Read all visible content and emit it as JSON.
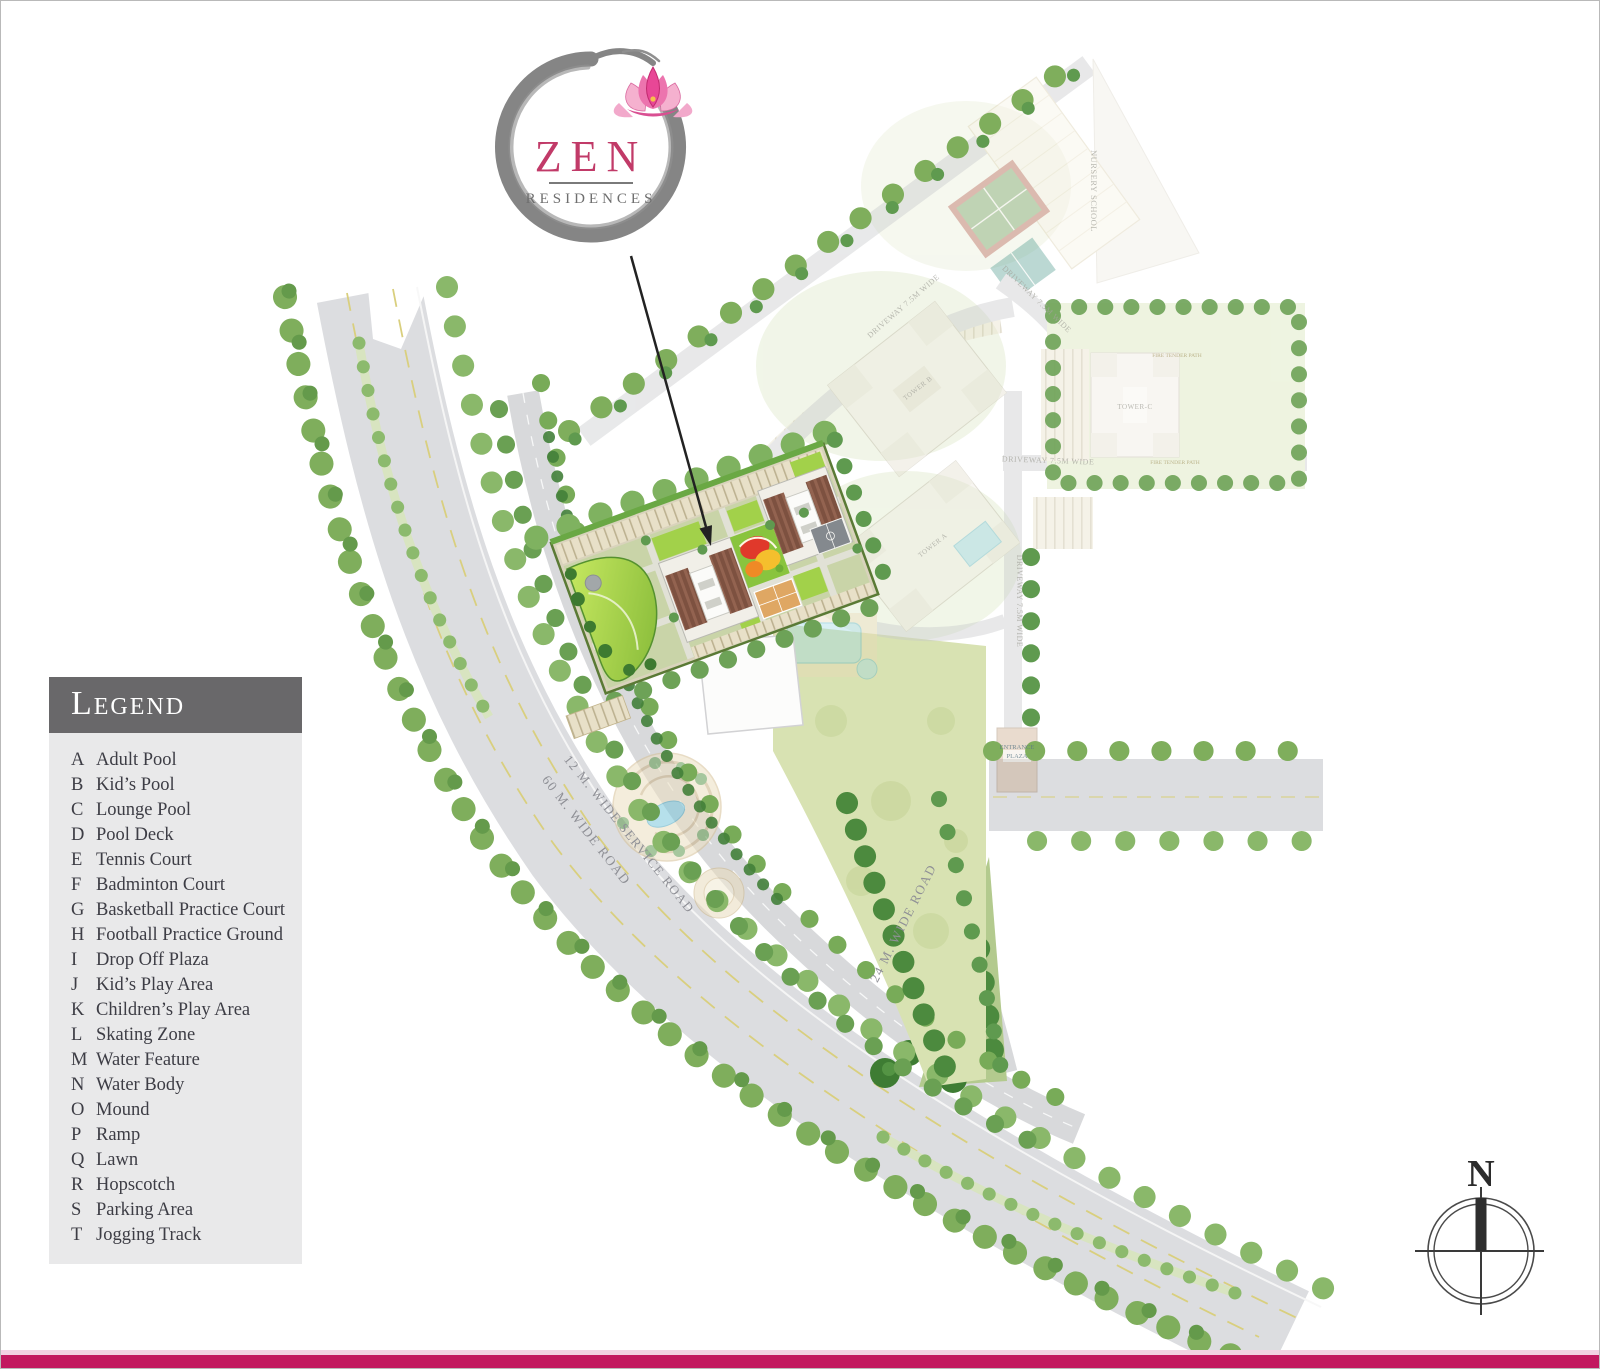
{
  "logo": {
    "title": "ZEN",
    "subtitle": "RESIDENCES"
  },
  "legend": {
    "title": "Legend",
    "items": [
      {
        "key": "A",
        "label": "Adult Pool"
      },
      {
        "key": "B",
        "label": "Kid’s Pool"
      },
      {
        "key": "C",
        "label": "Lounge Pool"
      },
      {
        "key": "D",
        "label": "Pool Deck"
      },
      {
        "key": "E",
        "label": "Tennis Court"
      },
      {
        "key": "F",
        "label": "Badminton Court"
      },
      {
        "key": "G",
        "label": "Basketball Practice Court"
      },
      {
        "key": "H",
        "label": "Football Practice Ground"
      },
      {
        "key": "I",
        "label": "Drop Off Plaza"
      },
      {
        "key": "J",
        "label": "Kid’s Play Area"
      },
      {
        "key": "K",
        "label": "Children’s Play Area"
      },
      {
        "key": "L",
        "label": "Skating Zone"
      },
      {
        "key": "M",
        "label": "Water Feature"
      },
      {
        "key": "N",
        "label": "Water Body"
      },
      {
        "key": "O",
        "label": "Mound"
      },
      {
        "key": "P",
        "label": "Ramp"
      },
      {
        "key": "Q",
        "label": "Lawn"
      },
      {
        "key": "R",
        "label": "Hopscotch"
      },
      {
        "key": "S",
        "label": "Parking Area"
      },
      {
        "key": "T",
        "label": "Jogging Track"
      }
    ]
  },
  "map": {
    "labels": {
      "main_road": "60 M. WIDE ROAD",
      "service_road": "12 M. WIDE SERVICE ROAD",
      "road_24m": "24 M. WIDE ROAD",
      "driveway_nw": "DRIVEWAY 7.5M WIDE",
      "driveway_ne": "DRIVEWAY 7.5M WIDE",
      "driveway_east": "DRIVEWAY 7.5M WIDE",
      "driveway_south": "DRIVEWAY 7.5M WIDE",
      "nursery_school": "NURSERY SCHOOL",
      "tower_a": "TOWER A",
      "tower_b": "TOWER B",
      "tower_c": "TOWER-C",
      "fire_tender_path_top": "FIRE TENDER PATH",
      "fire_tender_path_bottom": "FIRE TENDER PATH",
      "entrance_plaza_line1": "ENTRANCE",
      "entrance_plaza_line2": "PLAZA"
    }
  },
  "compass": {
    "north": "N"
  },
  "colors": {
    "accent_pink": "#c2195f",
    "logo_pink": "#c13a68",
    "legend_header_gray": "#69686a"
  }
}
